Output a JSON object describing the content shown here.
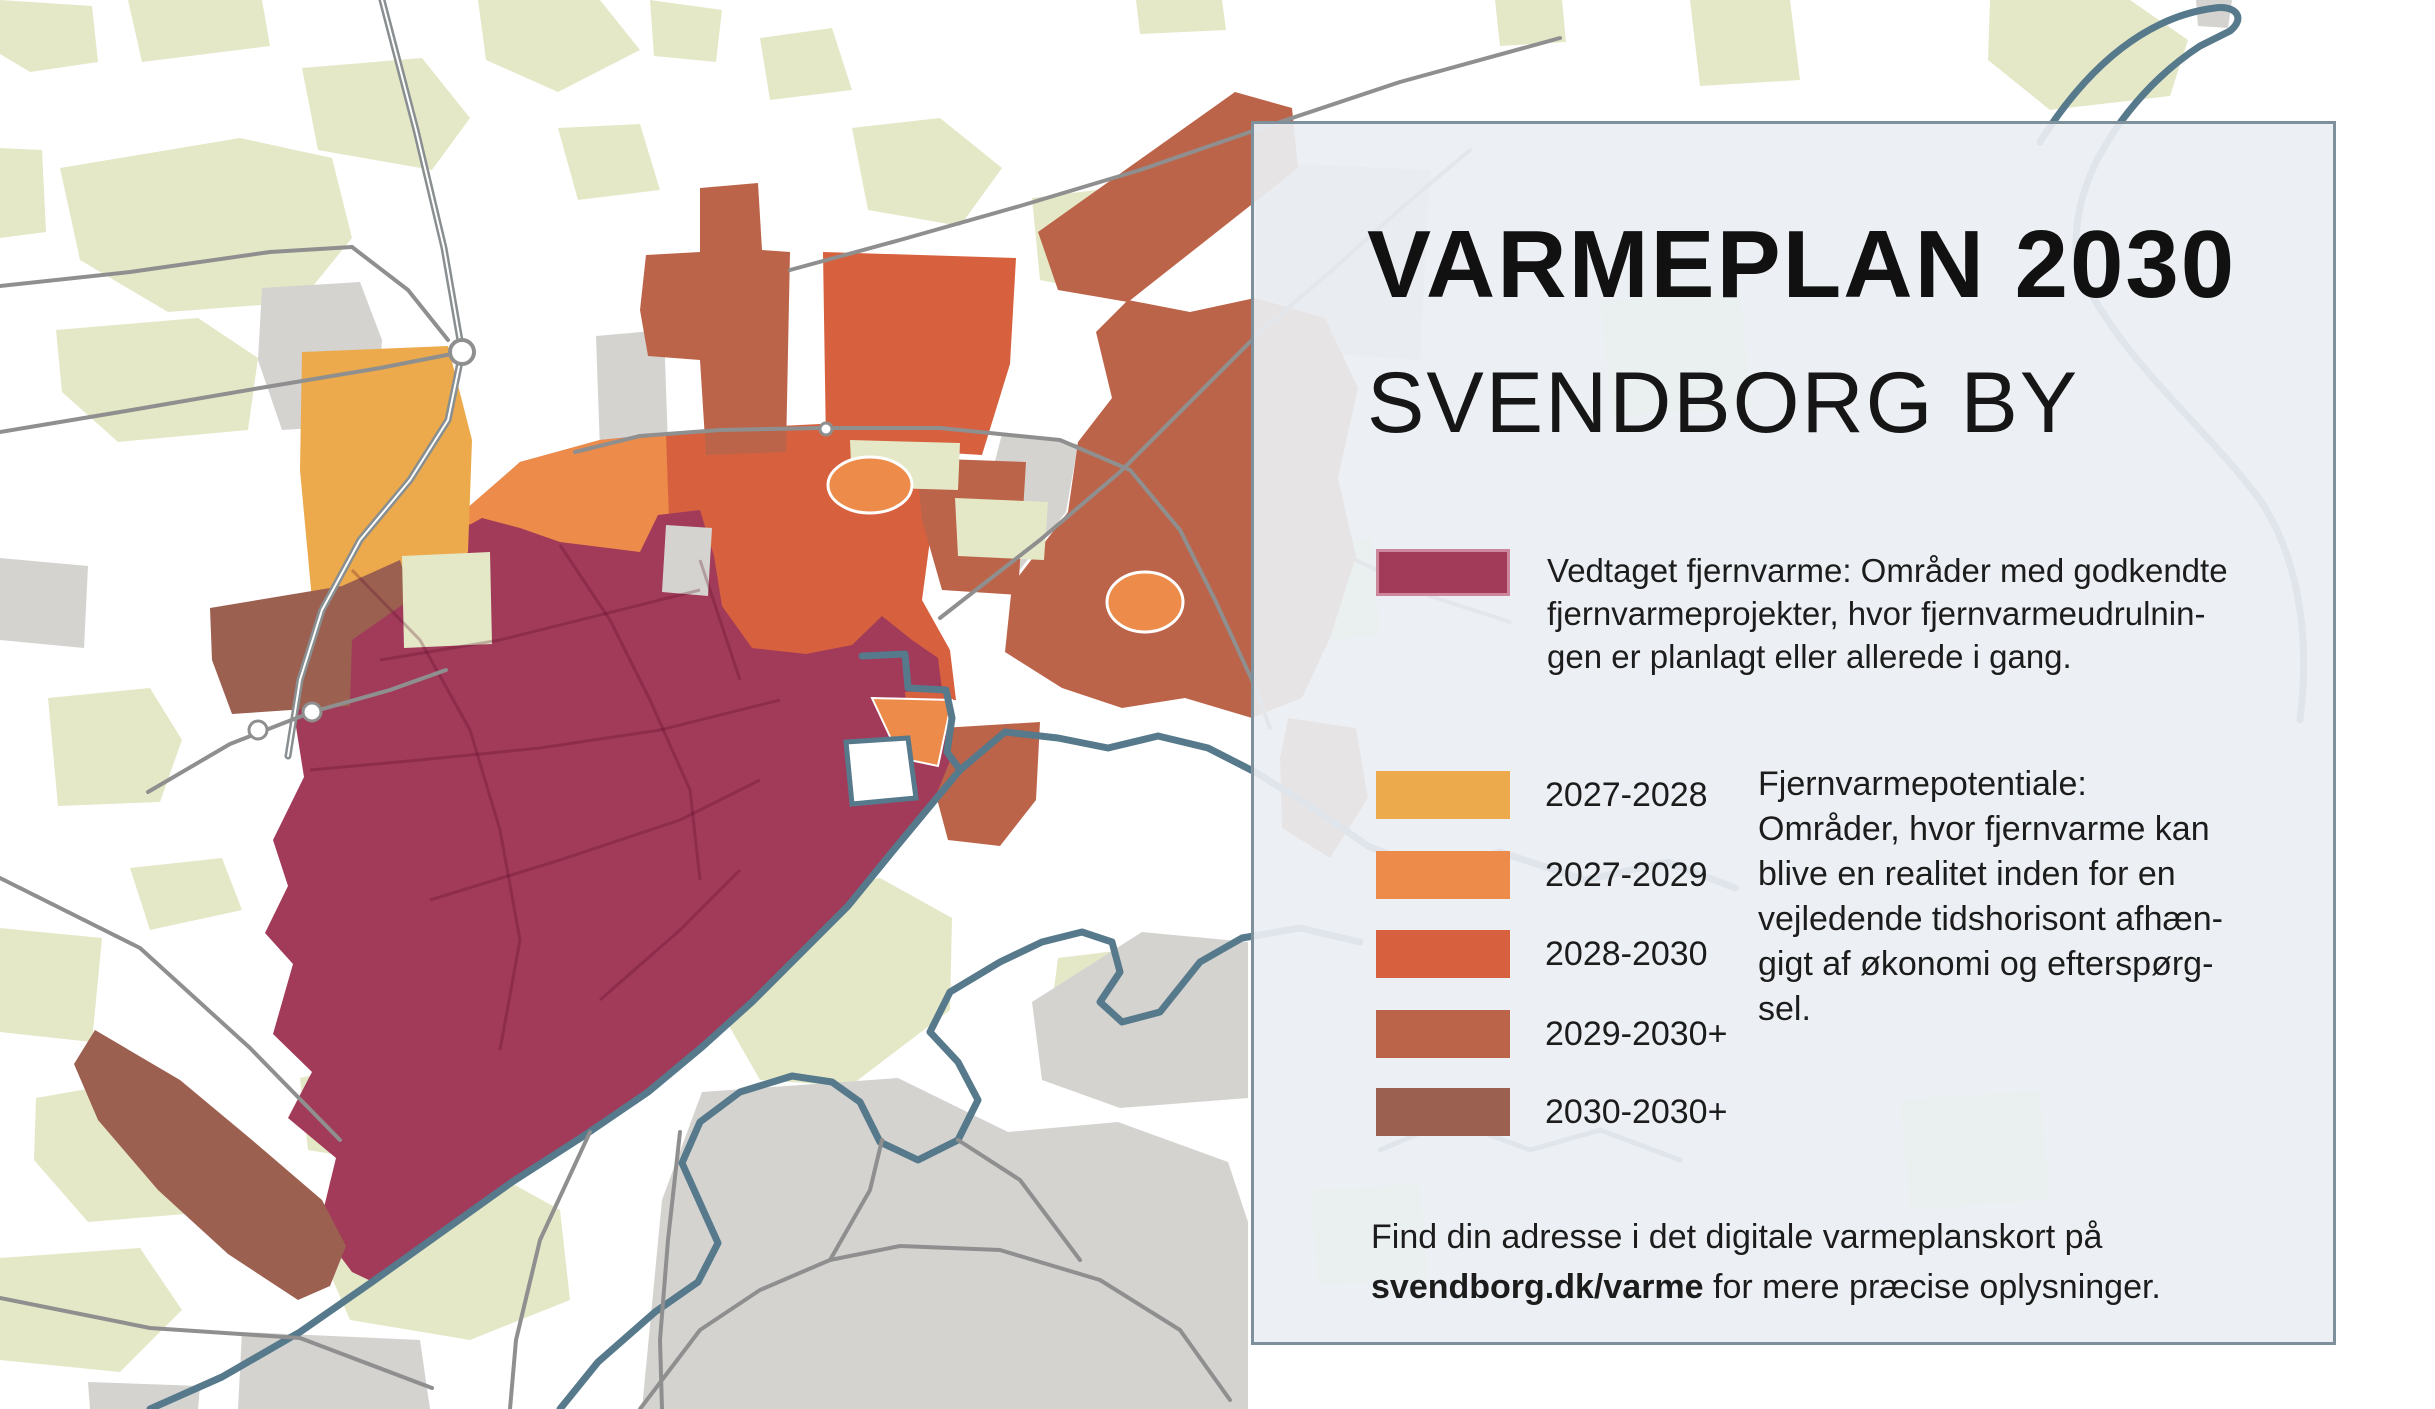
{
  "title": "VARMEPLAN 2030",
  "subtitle": "SVENDBORG BY",
  "adopted": {
    "color": "#a23a5a",
    "lines": [
      "Vedtaget fjernvarme: Områder med godkendte",
      "fjernvarmeprojekter, hvor fjernvarmeudrulnin-",
      "gen er planlagt eller allerede i gang."
    ]
  },
  "legend": [
    {
      "label": "2027-2028",
      "color": "#ecaa4c"
    },
    {
      "label": "2027-2029",
      "color": "#ec8b4a"
    },
    {
      "label": "2028-2030",
      "color": "#d7613e"
    },
    {
      "label": "2029-2030+",
      "color": "#bc6449"
    },
    {
      "label": "2030-2030+",
      "color": "#9c6051"
    }
  ],
  "potential": {
    "lines": [
      "Fjernvarmepotentiale:",
      "Områder, hvor fjernvarme kan",
      "blive en realitet inden for en",
      "vejledende tidshorisont afhæn-",
      "gigt af økonomi og efterspørg-",
      "sel."
    ]
  },
  "footer": {
    "line1": "Find din adresse i det digitale varmeplanskort på",
    "link": "svendborg.dk/varme",
    "line2_rest": " for mere præcise oplysninger."
  },
  "map": {
    "colors": {
      "background": "#ffffff",
      "field_green": "#e4e8c7",
      "builtup_gray": "#d4d3d0",
      "road_gray": "#8f8f8f",
      "coast_blue": "#56798b",
      "water": "#ffffff",
      "adopted_maroon": "#a23a5a",
      "plan_2027_2028": "#ecaa4c",
      "plan_2027_2029": "#ec8b4a",
      "plan_2028_2030": "#d7613e",
      "plan_2029_2030": "#bc6449",
      "plan_2030_2030": "#9c6051",
      "panel_background": "#eaeff3",
      "panel_border": "#7e909c"
    }
  }
}
